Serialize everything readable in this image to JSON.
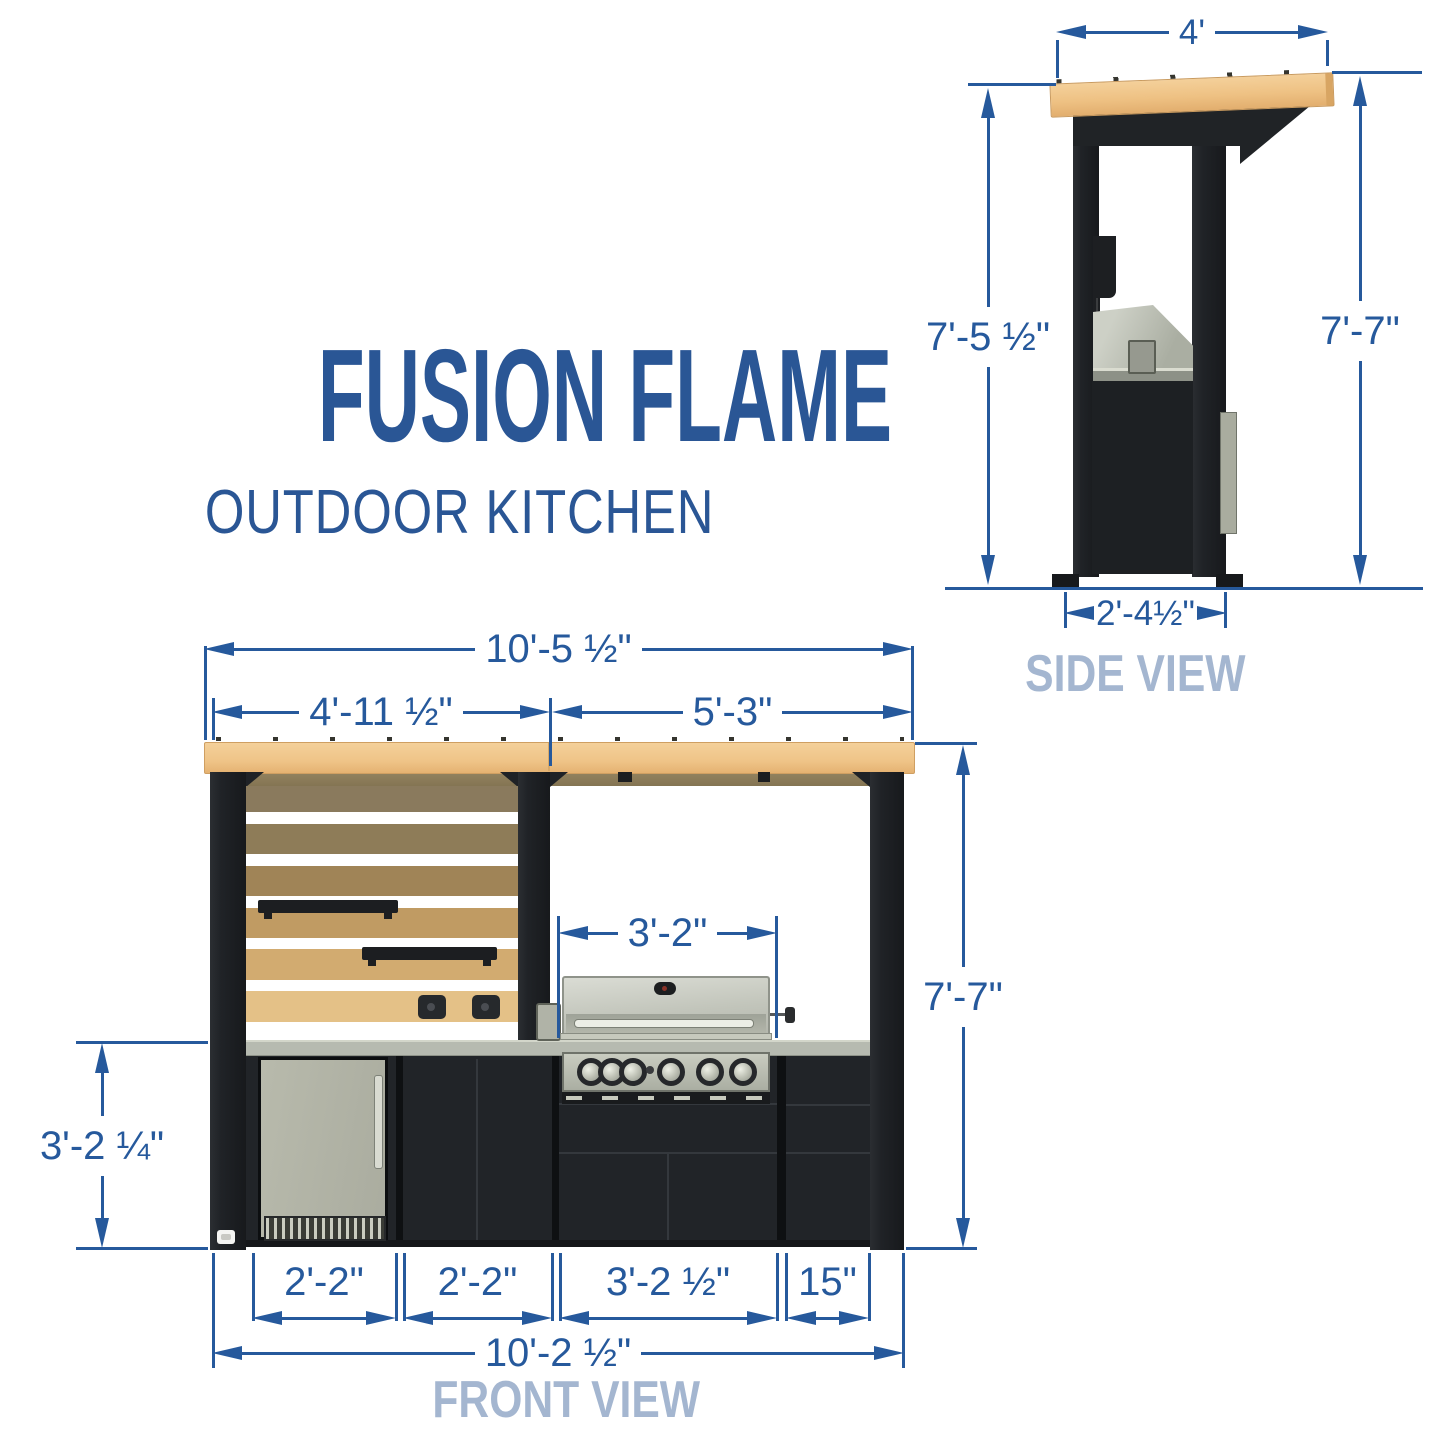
{
  "title": {
    "main": "FUSION FLAME",
    "subtitle": "OUTDOOR KITCHEN"
  },
  "side_view": {
    "label": "SIDE VIEW",
    "dims": {
      "roof_width": "4'",
      "height_left": "7'-5 ½\"",
      "height_right": "7'-7\"",
      "base_depth": "2'-4½\""
    }
  },
  "front_view": {
    "label": "FRONT VIEW",
    "dims": {
      "overall_width_top": "10'-5 ½\"",
      "pergola_left_span": "4'-11 ½\"",
      "pergola_right_span": "5'-3\"",
      "grill_width": "3'-2\"",
      "overall_height": "7'-7\"",
      "counter_height": "3'-2 ¼\"",
      "module_fridge": "2'-2\"",
      "module_cabinet": "2'-2\"",
      "module_grill": "3'-2 ½\"",
      "module_drawers": "15\"",
      "overall_width_bottom": "10'-2 ½\""
    }
  },
  "colors": {
    "dimension_blue": "#26599c",
    "view_label_blue": "#a4b6d0",
    "title_blue": "#2a5695",
    "wood": "#f0c78e",
    "frame_black": "#222528",
    "counter_gray": "#b6bab0",
    "stainless": "#c3c6bc"
  }
}
